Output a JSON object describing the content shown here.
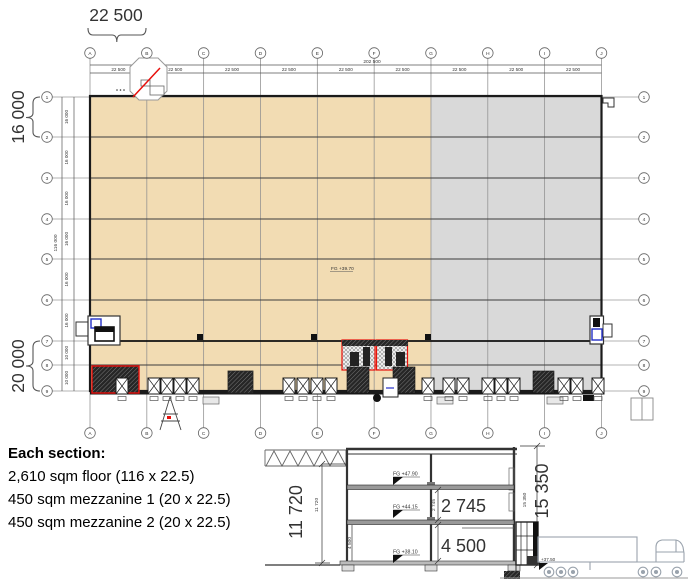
{
  "sheet": {
    "plan": {
      "column_labels": [
        "A",
        "B",
        "C",
        "D",
        "E",
        "F",
        "G",
        "H",
        "I",
        "J"
      ],
      "row_labels": [
        "1",
        "2",
        "3",
        "4",
        "5",
        "6",
        "7",
        "8",
        "9"
      ],
      "dim_bay_top": "22 500",
      "dim_total_top": "202 500",
      "dim_rows": [
        "16 000",
        "16 000",
        "16 000",
        "16 000",
        "16 000",
        "16 000",
        "10 000",
        "10 000"
      ],
      "dim_total_left": "116 000",
      "big_dim_top": "22 500",
      "big_dim_left_upper": "16 000",
      "big_dim_left_lower": "20 000",
      "floor_level": "FG +39.70"
    },
    "notes": {
      "title": "Each section:",
      "line1": "2,610 sqm floor (116 x 22.5)",
      "line2": "450 sqm mezzanine 1 (20 x 22.5)",
      "line3": "450 sqm mezzanine 2 (20 x 22.5)"
    },
    "section": {
      "big_dim_left": "11 720",
      "big_dim_right": "15 350",
      "big_dim_mezz": "2 745",
      "big_dim_ground": "4 500",
      "small_dim_left": "11 720",
      "small_dim_right": "15 350",
      "small_dim_mezz": "2 745",
      "small_dim_ground": "4 500",
      "level_top": "FG +47.90",
      "level_mezz": "FG +44.15",
      "level_floor": "FG +38.10",
      "level_yard": "+37.50"
    },
    "colors": {
      "warm_hall_fill": "#f2dcb3",
      "cold_hall_fill": "#d9d9d9",
      "dim_text": "#223349",
      "accent_red": "#e8100c",
      "accent_blue": "#2430c8"
    }
  }
}
